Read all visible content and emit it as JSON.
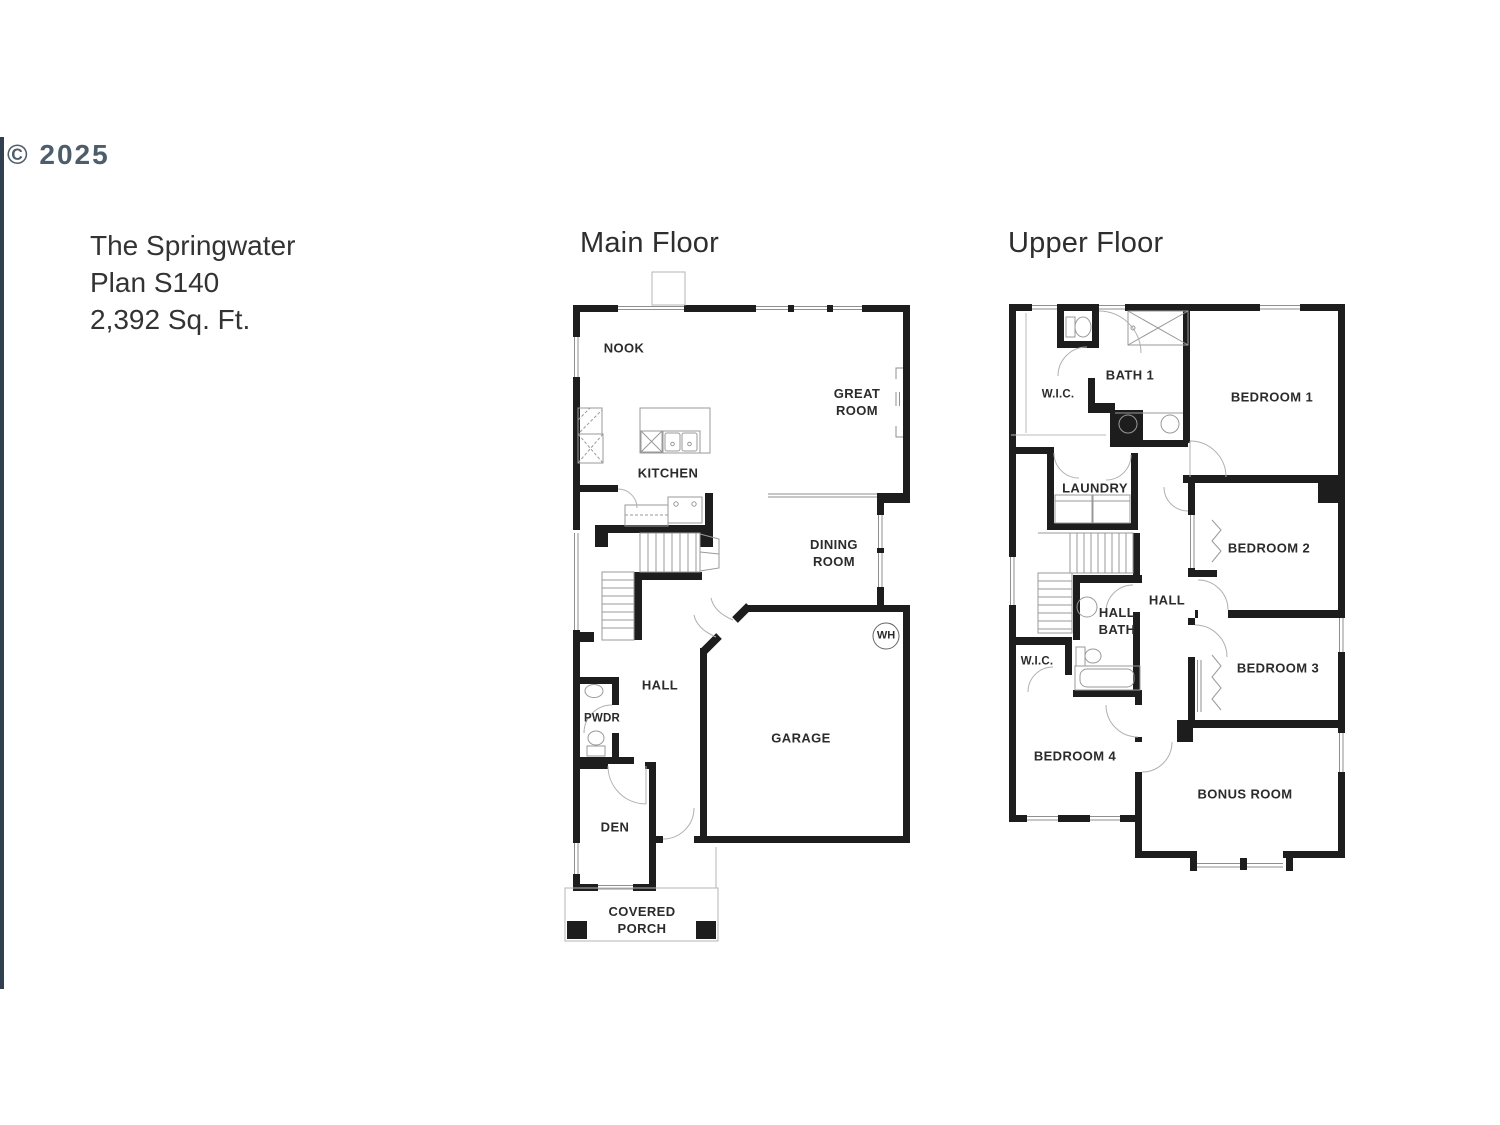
{
  "watermark": {
    "text": "© 2025",
    "bar_color": "#31404f"
  },
  "plan": {
    "name": "The Springwater",
    "number": "Plan S140",
    "sqft": "2,392 Sq. Ft."
  },
  "main_floor": {
    "title": "Main Floor",
    "labels": {
      "nook": "NOOK",
      "great_room": "GREAT\nROOM",
      "kitchen": "KITCHEN",
      "dining_room": "DINING\nROOM",
      "water_heater": "WH",
      "hall": "HALL",
      "powder": "PWDR",
      "garage": "GARAGE",
      "den": "DEN",
      "covered_porch": "COVERED\nPORCH"
    }
  },
  "upper_floor": {
    "title": "Upper Floor",
    "labels": {
      "wic_1": "W.I.C.",
      "bath_1": "BATH 1",
      "bedroom_1": "BEDROOM 1",
      "laundry": "LAUNDRY",
      "bedroom_2": "BEDROOM 2",
      "hall": "HALL",
      "hall_bath": "HALL\nBATH",
      "wic_2": "W.I.C.",
      "bedroom_3": "BEDROOM 3",
      "bedroom_4": "BEDROOM 4",
      "bonus_room": "BONUS ROOM"
    }
  },
  "colors": {
    "wall": "#1d1d1d",
    "thin_line": "#999999",
    "window_line": "#8f8f8f",
    "door_arc": "#b0b0b0",
    "watermark_bar": "#31404f",
    "background": "#ffffff"
  }
}
